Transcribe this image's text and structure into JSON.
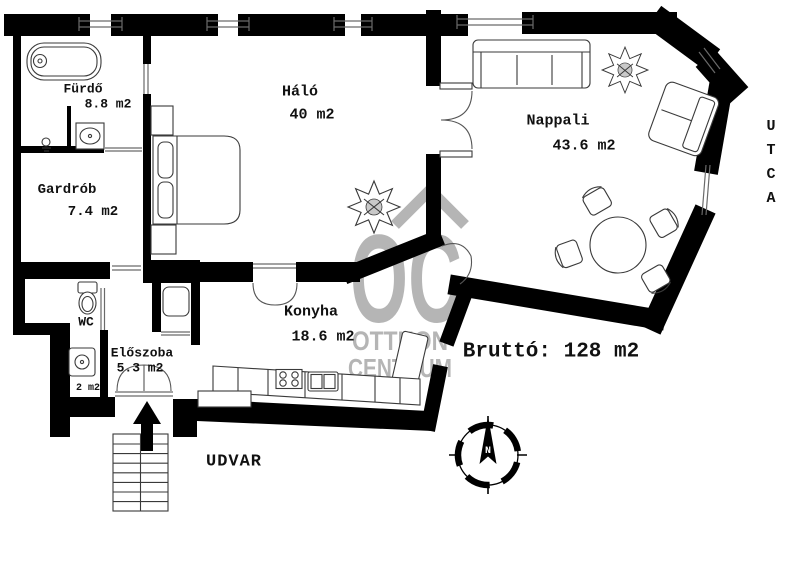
{
  "rooms": [
    {
      "name": "Fürdő",
      "area": "8.8 m2"
    },
    {
      "name": "Gardrób",
      "area": "7.4 m2"
    },
    {
      "name": "Háló",
      "area": "40 m2"
    },
    {
      "name": "Nappali",
      "area": "43.6 m2"
    },
    {
      "name": "WC",
      "area": "2 m2"
    },
    {
      "name": "Előszoba",
      "area": "5.3 m2"
    },
    {
      "name": "Konyha",
      "area": "18.6 m2"
    }
  ],
  "labels": {
    "gross_area": "Bruttó: 128 m2",
    "courtyard": "UDVAR",
    "street": "UTCA",
    "north": "N"
  },
  "watermark": {
    "monogram": "OC",
    "line1": "OTTHON",
    "line2": "CENTRUM"
  },
  "colors": {
    "wall": "#000000",
    "background": "#ffffff",
    "watermark": "#b5b5b5"
  }
}
